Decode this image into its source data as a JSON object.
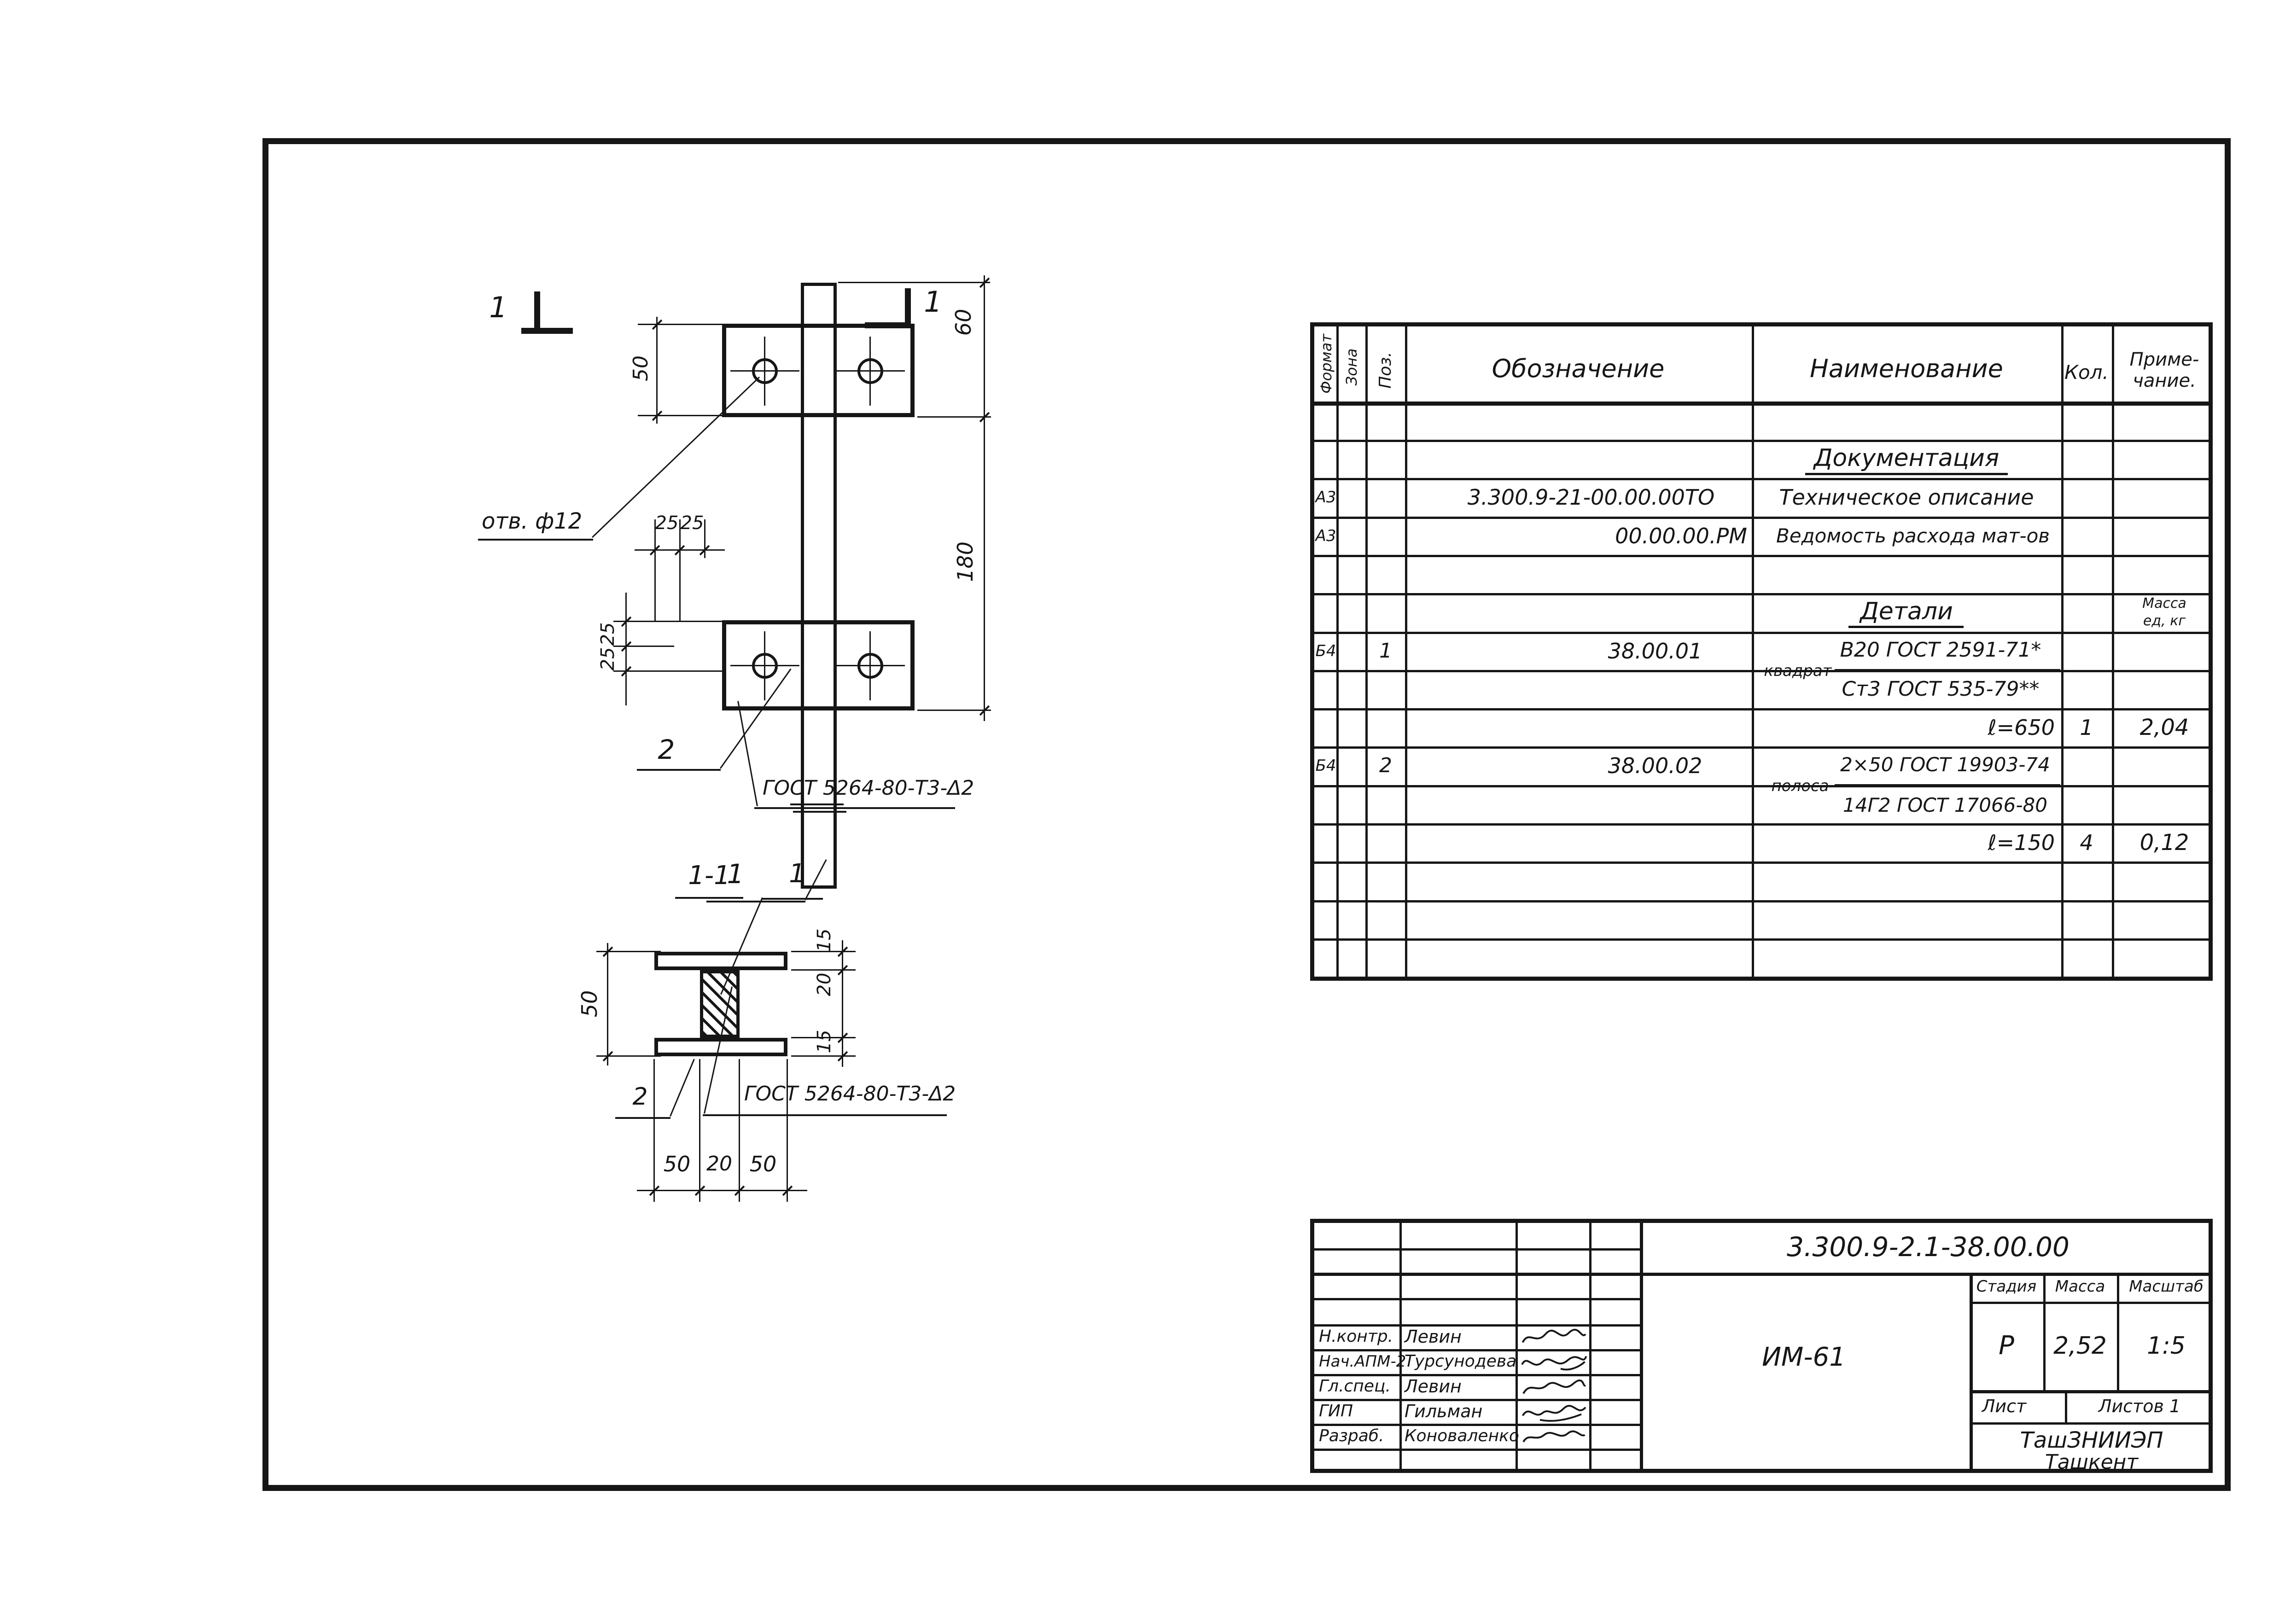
{
  "spec_table": {
    "col_headers": {
      "format": "Формат",
      "zone": "Зона",
      "pos": "Поз.",
      "designation": "Обозначение",
      "name": "Наименование",
      "qty": "Кол.",
      "note_line1": "Приме-",
      "note_line2": "чание."
    },
    "doc_section_title": "Документация",
    "rows": {
      "doc1": {
        "format": "А3",
        "designation": "3.300.9-21-00.00.00ТО",
        "name": "Техническое описание"
      },
      "doc2": {
        "format": "А3",
        "designation": "00.00.00.РМ",
        "name": "Ведомость расхода мат-ов"
      }
    },
    "details_section_title": "Детали",
    "mass_col_line1": "Масса",
    "mass_col_line2": "ед, кг",
    "detail1": {
      "format": "Б4",
      "pos": "1",
      "designation": "38.00.01",
      "profile": "квадрат",
      "material_top": "В20 ГОСТ 2591-71*",
      "material_bottom": "Ст3 ГОСТ 535-79**",
      "length": "ℓ=650",
      "qty": "1",
      "mass": "2,04"
    },
    "detail2": {
      "format": "Б4",
      "pos": "2",
      "designation": "38.00.02",
      "profile": "полоса",
      "material_top": "2×50 ГОСТ 19903-74",
      "material_bottom": "14Г2 ГОСТ 17066-80",
      "length": "ℓ=150",
      "qty": "4",
      "mass": "0,12"
    }
  },
  "main_view": {
    "cut_label_left": "1",
    "cut_label_right": "1",
    "hole_note": "отв. ф12",
    "weld_note": "ГОСТ 5264-80-Т3-Δ2",
    "pos_plate": "2",
    "pos_bar": "1",
    "dim_plate_h": "50",
    "dim_top": "60",
    "dim_height": "180",
    "dim_h25_1": "25",
    "dim_h25_2": "25",
    "dim_v25_1": "25",
    "dim_v25_2": "25"
  },
  "section_view": {
    "title": "1-1",
    "pos_bar": "1",
    "pos_plate": "2",
    "weld_note": "ГОСТ 5264-80-Т3-Δ2",
    "dim_height": "50",
    "dim_r15a": "15",
    "dim_r20": "20",
    "dim_r15b": "15",
    "dim_b50a": "50",
    "dim_b20": "20",
    "dim_b50b": "50"
  },
  "title_block": {
    "doc_number": "3.300.9-2.1-38.00.00",
    "project_code": "ИМ-61",
    "rows": [
      {
        "role": "Н.контр.",
        "name": "Левин"
      },
      {
        "role": "Нач.АПМ-2",
        "name": "Турсунодева"
      },
      {
        "role": "Гл.спец.",
        "name": "Левин"
      },
      {
        "role": "ГИП",
        "name": "Гильман"
      },
      {
        "role": "Разраб.",
        "name": "Коноваленко"
      }
    ],
    "stage_label": "Стадия",
    "mass_label": "Масса",
    "scale_label": "Масштаб",
    "stage": "Р",
    "mass": "2,52",
    "scale": "1:5",
    "sheet_label": "Лист",
    "sheets_label": "Листов 1",
    "org": "ТашЗНИИЭП",
    "city": "Ташкент"
  }
}
